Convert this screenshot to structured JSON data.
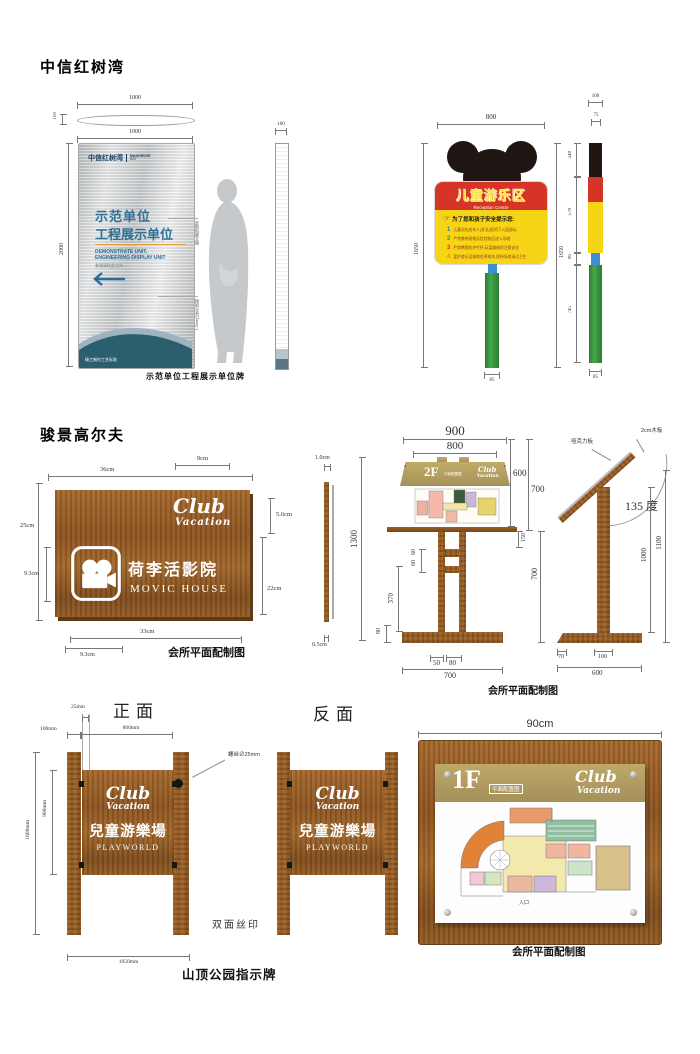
{
  "s1": {
    "title": "中信红树湾",
    "main": {
      "dim_plate_w": "1000",
      "dim_plate_t": "100",
      "dim_front_w": "1000",
      "dim_h": "2000",
      "dim_side_w": "100",
      "logo_cn": "中信红树湾",
      "logo_en1": "MANGROVE",
      "logo_en2": "BAY",
      "cn1": "示范单位",
      "cn2": "工程展示单位",
      "en1": "DEMONSTRATE UNIT,",
      "en2": "ENGINEERING DISPLAY UNIT",
      "dir": "参观请往此方向",
      "ann1": "图文腐蚀填漆",
      "ann2": "1.2mm拉丝不锈钢",
      "foot": "精工制作工艺标准",
      "caption": "示范单位工程展示单位牌"
    },
    "kids": {
      "dim_top": "800",
      "dim_h": "1650",
      "dim_pole_w": "85",
      "title": "儿童游乐区",
      "subtitle": "Reception Centre",
      "hand_icon": "☞",
      "notice": "为了您和孩子安全提示您:",
      "items": [
        {
          "n": "1",
          "t": "儿童须在成年人(家长)陪同下入园游玩"
        },
        {
          "n": "2",
          "t": "严禁携带宠物及危险物品进入场地"
        },
        {
          "n": "3",
          "t": "严禁攀爬防护栏杆,玩耍器械时注意安全"
        },
        {
          "n": "4",
          "t": "爱护游乐设施和花草树木,保持场地清洁卫生"
        }
      ],
      "side": {
        "dim_w": "100",
        "dim_w2": "75",
        "seg1": "248",
        "seg2": "578",
        "seg3": "80",
        "seg4": "745",
        "dim_base": "85",
        "dim_h": "1650"
      }
    }
  },
  "s2": {
    "title": "骏景高尔夫",
    "movie": {
      "d36": "36cm",
      "d9": "9cm",
      "d25": "25cm",
      "d93l": "9.3cm",
      "d56": "5.6cm",
      "d22": "22cm",
      "d33": "33cm",
      "d93b": "9.3cm",
      "logo1": "Club",
      "logo2": "Vacation",
      "cn": "荷李活影院",
      "en": "MOVIC HOUSE",
      "caption": "会所平面配制图"
    },
    "stand": {
      "d900": "900",
      "d800": "800",
      "d600": "600",
      "d700": "700",
      "d150": "150",
      "d60a": "60",
      "d60b": "60",
      "d370": "370",
      "d80": "80",
      "d50": "50",
      "d80b": "80",
      "d700b": "700",
      "d700r": "700",
      "d1300": "1300",
      "d10": "1.0cm",
      "d05": "0.5cm",
      "label": "2F",
      "sub": "平面配置图",
      "logo1": "Club",
      "logo2": "Vacation",
      "caption": "会所平面配制图"
    },
    "lectern": {
      "acrylic": "哑克力板",
      "wood2cm": "2cm木板",
      "angle": "135 度",
      "d1000": "1000",
      "d1100": "1100",
      "d70": "70",
      "d100": "100",
      "d600": "600"
    }
  },
  "s3": {
    "front_label": "正面",
    "back_label": "反面",
    "panel": {
      "logo1": "Club",
      "logo2": "Vacation",
      "cn": "兒童游樂場",
      "en": "PLAYWORLD"
    },
    "dims": {
      "d25": "25mm",
      "d100": "100mm",
      "d800": "800mm",
      "d1600": "1600mm",
      "d900": "900mm",
      "d1050": "1050mm"
    },
    "screw": "螺丝∅25mm",
    "silk": "双面丝印",
    "caption": "山顶公园指示牌",
    "b1f": {
      "d90": "90cm",
      "label": "1F",
      "sub": "平面配置图",
      "logo1": "Club",
      "logo2": "Vacation",
      "entrance": "入口",
      "caption": "会所平面配制图"
    }
  }
}
